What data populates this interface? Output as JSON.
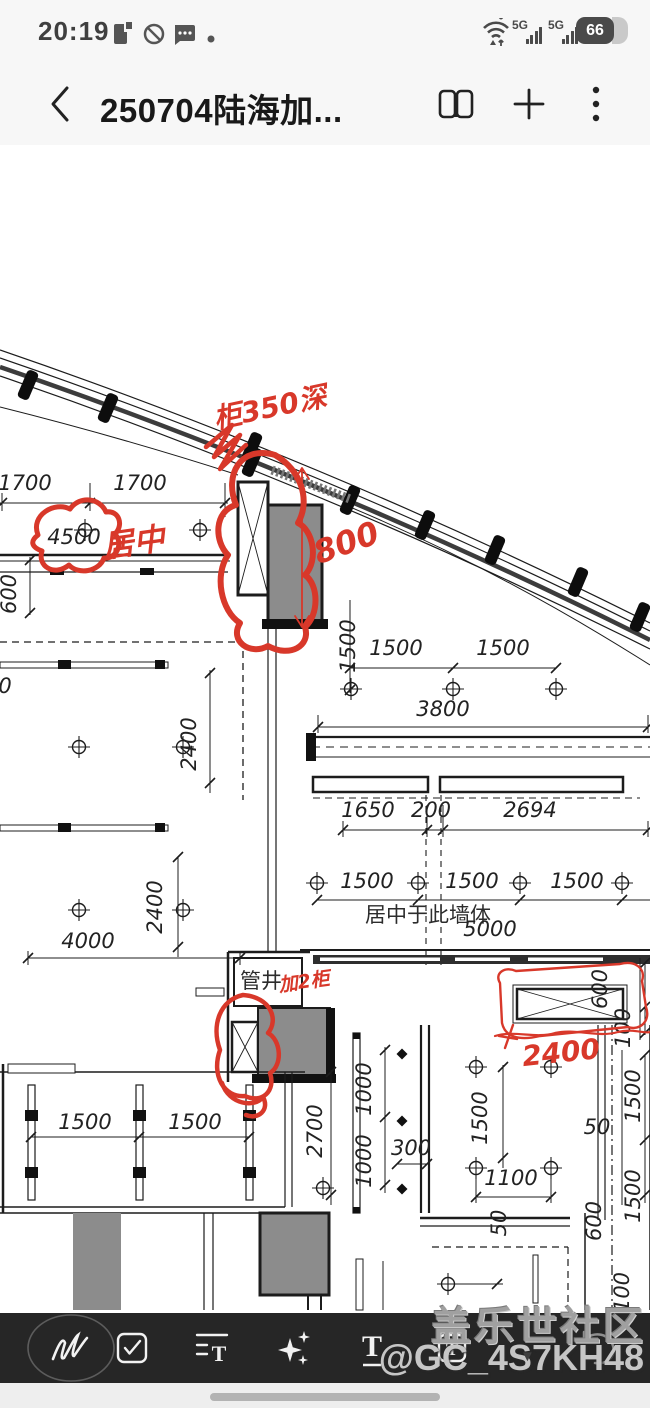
{
  "colors": {
    "red_ink": "#d8382a",
    "line": "#1c1c1c",
    "gray_fill": "#8c8c8c",
    "toolbar_bg": "#262626",
    "statusbar_bg": "#f7f7f7",
    "watermark": "#a0a0a0"
  },
  "status_bar": {
    "time": "20:19",
    "battery_percent": "66",
    "badge_5g_1": "5G",
    "badge_5g_2": "5G"
  },
  "header": {
    "title": "250704陆海加...",
    "back_icon": "back-chevron",
    "reader_icon": "reader-mode",
    "add_icon": "add",
    "more_icon": "more-options"
  },
  "drawing": {
    "dims": [
      {
        "text": "1700",
        "x": 25,
        "y": 345
      },
      {
        "text": "1700",
        "x": 140,
        "y": 345
      },
      {
        "text": "4500",
        "x": 74,
        "y": 399,
        "size": 27
      },
      {
        "text": "600",
        "x": 16,
        "y": 449,
        "rot": -90
      },
      {
        "text": "1500",
        "x": 355,
        "y": 501,
        "rot": -90
      },
      {
        "text": "1500",
        "x": 396,
        "y": 510
      },
      {
        "text": "1500",
        "x": 503,
        "y": 510
      },
      {
        "text": "3800",
        "x": 443,
        "y": 571,
        "size": 24
      },
      {
        "text": "2400",
        "x": 196,
        "y": 599,
        "rot": -90
      },
      {
        "text": "2400",
        "x": 162,
        "y": 762,
        "rot": -90
      },
      {
        "text": "4000",
        "x": 88,
        "y": 803,
        "size": 24
      },
      {
        "text": "1650",
        "x": 368,
        "y": 672
      },
      {
        "text": "200",
        "x": 431,
        "y": 672
      },
      {
        "text": "2694",
        "x": 530,
        "y": 672
      },
      {
        "text": "1500",
        "x": 367,
        "y": 743
      },
      {
        "text": "1500",
        "x": 472,
        "y": 743
      },
      {
        "text": "1500",
        "x": 577,
        "y": 743
      },
      {
        "text": "居中于此墙体",
        "x": 428,
        "y": 777,
        "size": 17,
        "cls": "cn"
      },
      {
        "text": "5000",
        "x": 490,
        "y": 791,
        "size": 24
      },
      {
        "text": "管井",
        "x": 261,
        "y": 843,
        "size": 19,
        "cls": "cn"
      },
      {
        "text": "600",
        "x": 607,
        "y": 844,
        "rot": -90
      },
      {
        "text": "100",
        "x": 630,
        "y": 883,
        "rot": -90
      },
      {
        "text": "1500",
        "x": 640,
        "y": 951,
        "rot": -90
      },
      {
        "text": "50",
        "x": 597,
        "y": 989
      },
      {
        "text": "1500",
        "x": 640,
        "y": 1051,
        "rot": -90
      },
      {
        "text": "600",
        "x": 601,
        "y": 1076,
        "rot": -90
      },
      {
        "text": "1500",
        "x": 85,
        "y": 984
      },
      {
        "text": "1500",
        "x": 195,
        "y": 984
      },
      {
        "text": "2700",
        "x": 322,
        "y": 986,
        "rot": -90
      },
      {
        "text": "1000",
        "x": 371,
        "y": 944,
        "rot": -90
      },
      {
        "text": "1000",
        "x": 371,
        "y": 1016,
        "rot": -90
      },
      {
        "text": "300",
        "x": 411,
        "y": 1010
      },
      {
        "text": "1500",
        "x": 487,
        "y": 973,
        "rot": -90
      },
      {
        "text": "1100",
        "x": 511,
        "y": 1040
      },
      {
        "text": "50",
        "x": 506,
        "y": 1078,
        "rot": -90
      },
      {
        "text": "100",
        "x": 629,
        "y": 1147,
        "rot": -90
      },
      {
        "text": "0",
        "x": 5,
        "y": 548,
        "size": 24
      }
    ],
    "red_notes": [
      {
        "text": "柜350深",
        "x": 272,
        "y": 272,
        "rot": -12,
        "size": 28
      },
      {
        "text": "居中",
        "x": 135,
        "y": 408,
        "rot": -8,
        "size": 31
      },
      {
        "text": "800",
        "x": 350,
        "y": 408,
        "rot": -20,
        "size": 32
      },
      {
        "text": "加2柜",
        "x": 305,
        "y": 843,
        "rot": -8,
        "size": 19
      },
      {
        "text": "2400",
        "x": 562,
        "y": 917,
        "rot": -6,
        "size": 28
      }
    ]
  },
  "toolbar": {
    "tools": [
      {
        "name": "handwriting-pen"
      },
      {
        "name": "checkbox"
      },
      {
        "name": "text-format",
        "letter": "T"
      },
      {
        "name": "ai-sparkles",
        "star": "✦"
      },
      {
        "name": "text-style",
        "letter": "T"
      },
      {
        "name": "text-box",
        "letter": "T"
      }
    ],
    "caret": "▼"
  },
  "watermark": {
    "line1": "盖乐世社区",
    "line2": "@GC_4S7KH48"
  }
}
